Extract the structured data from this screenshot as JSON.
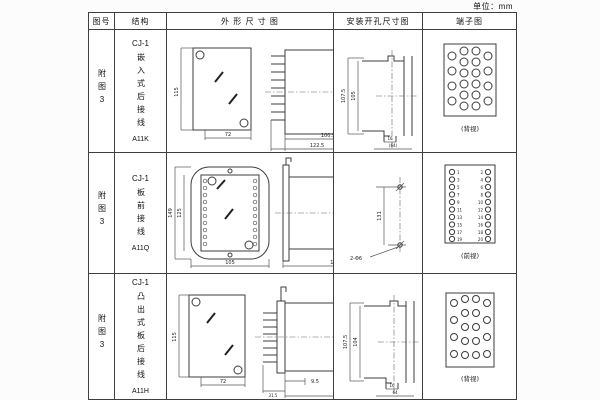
{
  "page": {
    "unit_label": "单位：mm"
  },
  "table": {
    "headers": [
      "图号",
      "结构",
      "外 形 尺 寸 图",
      "安装开孔尺寸图",
      "端子图"
    ],
    "rows": [
      {
        "figure_no": "附图3",
        "structure": {
          "series": "CJ-1",
          "mounting": "嵌入式后接线",
          "model": "A11K"
        },
        "outline_dims": {
          "front_height": "115",
          "front_width": "72",
          "body_depth": "100.5",
          "total_depth": "122.5",
          "flange_depth": "35"
        },
        "install_dims": {
          "outer_height": "107.5",
          "inner_height": "105",
          "slot_width": "16",
          "opening_width": "(64)"
        },
        "terminal": {
          "caption": "(背视)"
        }
      },
      {
        "figure_no": "附图3",
        "structure": {
          "series": "CJ-1",
          "mounting": "板前接线",
          "model": "A11Q"
        },
        "outline_dims": {
          "front_height": "149",
          "inner_height": "125",
          "front_width": "105",
          "body_depth": "156",
          "side_height": "115"
        },
        "install_dims": {
          "hole_pitch": "131",
          "hole_spec": "2-Φ6"
        },
        "terminal": {
          "caption": "(前视)",
          "left_numbers": [
            "1",
            "3",
            "5",
            "7",
            "9",
            "11",
            "13",
            "15",
            "17",
            "19"
          ],
          "right_numbers": [
            "2",
            "4",
            "6",
            "8",
            "10",
            "12",
            "14",
            "16",
            "18",
            "20"
          ]
        }
      },
      {
        "figure_no": "附图3",
        "structure": {
          "series": "CJ-1",
          "mounting": "凸出式板后接线",
          "model": "A11H"
        },
        "outline_dims": {
          "front_height": "115",
          "front_width": "72",
          "fin_depth": "31.5",
          "gap_depth": "9.5",
          "body_depth": "126"
        },
        "install_dims": {
          "outer_height": "107.5",
          "inner_height": "104",
          "slot_width": "16",
          "opening_width": "64"
        },
        "terminal": {
          "caption": "(背视)"
        }
      }
    ]
  }
}
